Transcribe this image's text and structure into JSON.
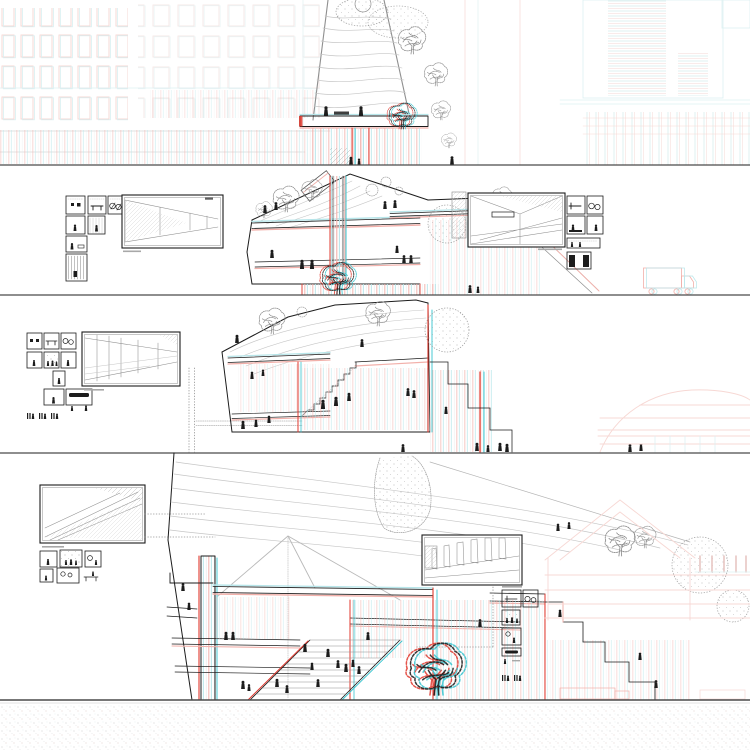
{
  "artwork": {
    "title": "Anaglyph architectural board: four stacked section-perspective bands of a tapering tower with roof gardens, grand stairs, figures and legend vignettes",
    "medium": "red/cyan stereo line drawing on white",
    "bands": [
      {
        "id": "band-1",
        "label": "tower top with park deck and city facades",
        "y_range": [
          0,
          165
        ]
      },
      {
        "id": "band-2",
        "label": "upper living levels with roof garden",
        "y_range": [
          165,
          295
        ]
      },
      {
        "id": "band-3",
        "label": "mid levels with interior stairs",
        "y_range": [
          295,
          453
        ]
      },
      {
        "id": "band-4",
        "label": "ground levels with pyramid skylight, grand stair and plaza",
        "y_range": [
          453,
          700
        ]
      },
      {
        "id": "footer",
        "label": "stippled ground",
        "y_range": [
          700,
          750
        ]
      }
    ],
    "colors": {
      "ink": "#1c1c1c",
      "red": "#e0392f",
      "cyan": "#35c4cf",
      "red_pale": "#f2b0aa",
      "cyan_pale": "#b8e6ea",
      "red_faint": "#f7d8d4",
      "cyan_faint": "#def1f3",
      "gray": "#8f8f8f",
      "gray_light": "#c6c6c6",
      "separator": "#4a4a4a",
      "paper": "#ffffff"
    },
    "legend_clusters": [
      {
        "id": "band-2-left",
        "thumbnails": 7,
        "framed_view": "interior perspective, hatched tapering hall",
        "caption_legible": false
      },
      {
        "id": "band-2-right",
        "thumbnails": 6,
        "framed_view": "interior perspective, seating area with hatched ceiling",
        "caption_legible": false
      },
      {
        "id": "band-3-left",
        "thumbnails": 9,
        "framed_view": "interior perspective, colonnade over sloped floor",
        "caption_legible": false
      },
      {
        "id": "band-4-left",
        "thumbnails": 6,
        "framed_view": "perspective of long cascading stair",
        "caption_legible": false
      },
      {
        "id": "band-4-right",
        "thumbnails": 6,
        "framed_view": "perspective of tapering fin columns",
        "caption_legible": false
      }
    ],
    "context": {
      "left_facades": "pale red/cyan window grids",
      "right_top_facade": "louvered slab facade",
      "right_mid": "domed hall outline (faint pink)",
      "right_bottom": "gabled hall outline (faint pink)",
      "vehicle": "box truck outline"
    }
  }
}
